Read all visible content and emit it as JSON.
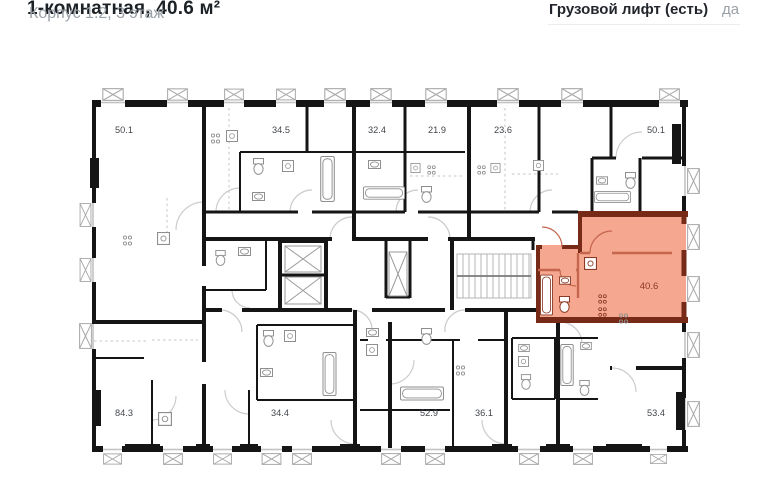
{
  "header": {
    "title": "1-комнатная, 40.6 м²",
    "subtitle": "Корпус 1.2, 3 этаж"
  },
  "info": {
    "label": "Грузовой лифт (есть)",
    "value": "да"
  },
  "floorplan": {
    "highlighted": {
      "area": "40.6"
    },
    "top_units": [
      {
        "area": "50.1"
      },
      {
        "area": "34.5"
      },
      {
        "area": "32.4"
      },
      {
        "area": "21.9"
      },
      {
        "area": "23.6"
      },
      {
        "area": "50.1"
      }
    ],
    "bottom_units": [
      {
        "area": "84.3"
      },
      {
        "area": "34.4"
      },
      {
        "area": "52.9"
      },
      {
        "area": "36.1"
      },
      {
        "area": "53.4"
      }
    ],
    "colors": {
      "highlight_fill": "#F6A78F",
      "highlight_wall": "#772A18",
      "wall": "#151515"
    }
  }
}
